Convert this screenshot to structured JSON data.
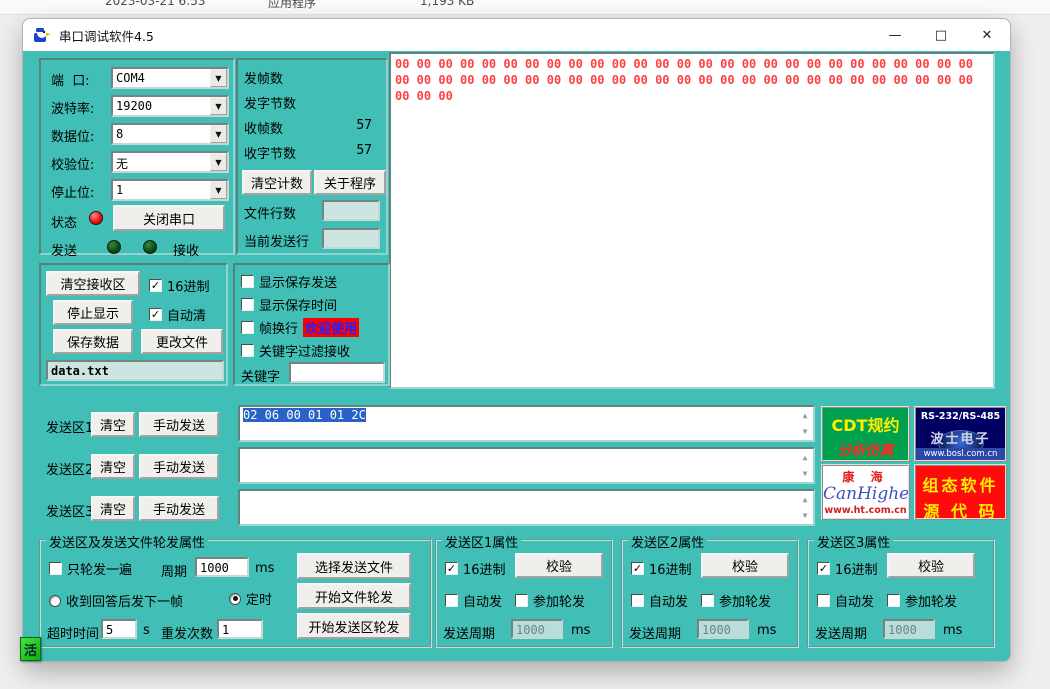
{
  "desktop": {
    "file_date": "2023-03-21 6:53",
    "file_type": "应用程序",
    "file_size": "1,193 KB"
  },
  "window": {
    "title": "串口调试软件4.5",
    "icon": "duck-app-icon",
    "controls": {
      "minimize": "—",
      "maximize": "□",
      "close": "✕"
    }
  },
  "port_panel": {
    "fields": [
      {
        "label": "端  口:",
        "value": "COM4"
      },
      {
        "label": "波特率:",
        "value": "19200"
      },
      {
        "label": "数据位:",
        "value": "8"
      },
      {
        "label": "校验位:",
        "value": "无"
      },
      {
        "label": "停止位:",
        "value": "1"
      }
    ],
    "status_label": "状态",
    "close_port_button": "关闭串口",
    "send_label": "发送",
    "receive_label": "接收"
  },
  "counter_panel": {
    "rows": [
      {
        "label": "发帧数",
        "value": ""
      },
      {
        "label": "发字节数",
        "value": ""
      },
      {
        "label": "收帧数",
        "value": "57"
      },
      {
        "label": "收字节数",
        "value": "57"
      }
    ],
    "clear_count_button": "清空计数",
    "about_button": "关于程序",
    "file_lines_label": "文件行数",
    "current_line_label": "当前发送行",
    "file_lines_value": "",
    "current_line_value": ""
  },
  "receive_area": {
    "lines": [
      "00 00 00 00 00 00 00 00 00 00 00 00 00 00 00 00 00 00 00 00 00 00 00 00 00 00 00",
      "00 00 00 00 00 00 00 00 00 00 00 00 00 00 00 00 00 00 00 00 00 00 00 00 00 00 00",
      "00 00 00"
    ],
    "text_color": "#ff4040"
  },
  "receive_controls": {
    "clear_button": "清空接收区",
    "hex_checkbox": {
      "label": "16进制",
      "checked": true
    },
    "stop_button": "停止显示",
    "autoclear_checkbox": {
      "label": "自动清",
      "checked": true
    },
    "save_button": "保存数据",
    "change_file_button": "更改文件",
    "filename": "data.txt"
  },
  "display_options": {
    "checkboxes": [
      {
        "label": "显示保存发送",
        "checked": false
      },
      {
        "label": "显示保存时间",
        "checked": false
      },
      {
        "label": "帧换行",
        "checked": false
      },
      {
        "label": "关键字过滤接收",
        "checked": false
      }
    ],
    "welcome_badge": "欢迎使用",
    "badge_bg": "#ff0000",
    "badge_color": "#2222ff",
    "keyword_label": "关键字",
    "keyword_value": ""
  },
  "send_rows": [
    {
      "label": "发送区1",
      "clear_button": "清空",
      "send_button": "手动发送",
      "value": "02 06 00 01 01 2C",
      "selected": true
    },
    {
      "label": "发送区2",
      "clear_button": "清空",
      "send_button": "手动发送",
      "value": "",
      "selected": false
    },
    {
      "label": "发送区3",
      "clear_button": "清空",
      "send_button": "手动发送",
      "value": "",
      "selected": false
    }
  ],
  "ad_logos": [
    {
      "line1": "CDT规约",
      "line2": "分析仿真"
    },
    {
      "line1": "RS-232/RS-485",
      "line2": "波士电子",
      "line3": "www.bosl.com.cn"
    },
    {
      "line1": "康 海",
      "line2": "CanHigher",
      "line3": "www.ht.com.cn"
    },
    {
      "line1": "组态软件",
      "line2": "源 代 码"
    }
  ],
  "rotation_panel": {
    "title": "发送区及发送文件轮发属性",
    "once_checkbox": {
      "label": "只轮发一遍",
      "checked": false
    },
    "period_label": "周期",
    "period_value": "1000",
    "period_unit": "ms",
    "radio_answer": {
      "label": "收到回答后发下一帧",
      "selected": false
    },
    "radio_timer": {
      "label": "定时",
      "selected": true
    },
    "timeout_label": "超时时间",
    "timeout_value": "5",
    "timeout_unit": "s",
    "retry_label": "重发次数",
    "retry_value": "1",
    "select_file_button": "选择发送文件",
    "start_file_button": "开始文件轮发",
    "start_area_button": "开始发送区轮发"
  },
  "send_area_panels": [
    {
      "title": "发送区1属性",
      "hex_checkbox": {
        "label": "16进制",
        "checked": true
      },
      "verify_button": "校验",
      "auto_checkbox": {
        "label": "自动发",
        "checked": false
      },
      "join_checkbox": {
        "label": "参加轮发",
        "checked": false
      },
      "period_label": "发送周期",
      "period_value": "1000",
      "period_unit": "ms"
    },
    {
      "title": "发送区2属性",
      "hex_checkbox": {
        "label": "16进制",
        "checked": true
      },
      "verify_button": "校验",
      "auto_checkbox": {
        "label": "自动发",
        "checked": false
      },
      "join_checkbox": {
        "label": "参加轮发",
        "checked": false
      },
      "period_label": "发送周期",
      "period_value": "1000",
      "period_unit": "ms"
    },
    {
      "title": "发送区3属性",
      "hex_checkbox": {
        "label": "16进制",
        "checked": true
      },
      "verify_button": "校验",
      "auto_checkbox": {
        "label": "自动发",
        "checked": false
      },
      "join_checkbox": {
        "label": "参加轮发",
        "checked": false
      },
      "period_label": "发送周期",
      "period_value": "1000",
      "period_unit": "ms"
    }
  ],
  "ime_indicator": "活",
  "theme": {
    "client_bg": "#41beb5",
    "selection_blue": "#2a63c8",
    "hex_red": "#ff4040"
  }
}
